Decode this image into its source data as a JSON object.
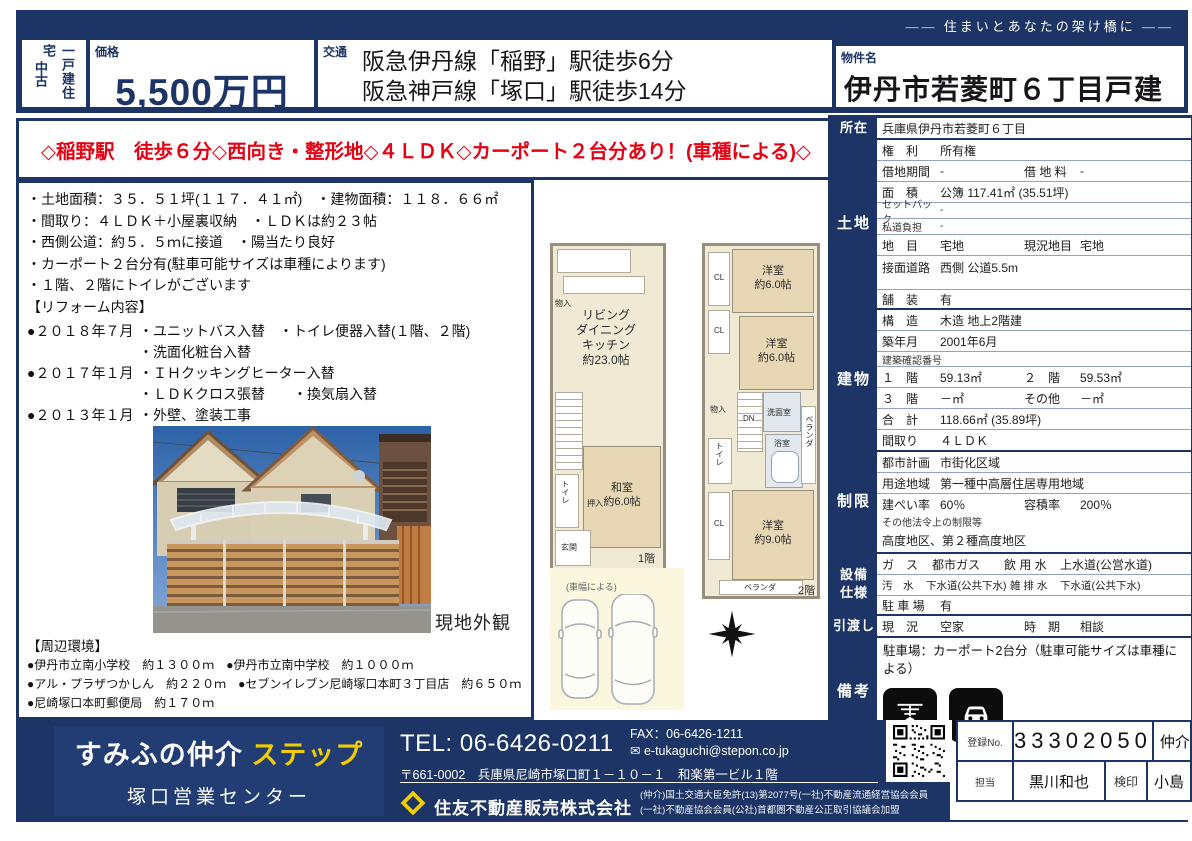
{
  "colors": {
    "navy": "#1c3566",
    "red": "#e60012",
    "yellow": "#f3cd00"
  },
  "header": {
    "tagline": "―― 住まいとあなたの架け橋に ――",
    "category_main": "一戸建住宅",
    "category_sub": "中古",
    "price_label": "価格",
    "price": "5,500万円",
    "traffic_label": "交通",
    "traffic_line1": "阪急伊丹線「稲野」駅徒歩6分",
    "traffic_line2": "阪急神戸線「塚口」駅徒歩14分",
    "name_label": "物件名",
    "name": "伊丹市若菱町６丁目戸建"
  },
  "catchcopy": "◇稲野駅　徒歩６分◇西向き・整形地◇４ＬＤＫ◇カーポート２台分あり！(車種による)◇",
  "notes": {
    "b1": "・土地面積：３５．５１坪(１１７．４１㎡)　・建物面積：１１８．６６㎡",
    "b2": "・間取り：４ＬＤＫ＋小屋裏収納　・ＬＤＫは約２３帖",
    "b3": "・西側公道：約５．５ｍに接道　・陽当たり良好",
    "b4": "・カーポート２台分有(駐車可能サイズは車種によります)",
    "b5": "・１階、２階にトイレがございます",
    "reform_title": "【リフォーム内容】",
    "r1_date": "●２０１８年７月",
    "r1_item": "・ユニットバス入替　・トイレ便器入替(１階、２階)",
    "r2_date": "",
    "r2_item": "・洗面化粧台入替",
    "r3_date": "●２０１７年１月",
    "r3_item": "・ＩＨクッキングヒーター入替",
    "r4_date": "",
    "r4_item": "・ＬＤＫクロス張替　　・換気扇入替",
    "r5_date": "●２０１３年１月",
    "r5_item": "・外壁、塗装工事",
    "photo_caption": "現地外観",
    "env_title": "【周辺環境】",
    "e1": "●伊丹市立南小学校　約１３００ｍ　●伊丹市立南中学校　約１０００ｍ",
    "e2": "●アル・プラザつかしん　約２２０ｍ　●セブンイレブン尼崎塚口本町３丁目店　約６５０ｍ",
    "e3": "●尼崎塚口本町郵便局　約１７０ｍ"
  },
  "floorplan": {
    "f1_ldk": "リビング\nダイニング\nキッチン\n約23.0帖",
    "f1_washitsu": "和室\n約6.0帖",
    "f1_toilet": "トイレ",
    "f1_monoire": "物入",
    "f1_oshiire": "押入",
    "f1_genkan": "玄関",
    "f1_floor": "1階",
    "f2_room1": "洋室\n約6.0帖",
    "f2_room2": "洋室\n約6.0帖",
    "f2_room3": "洋室\n約9.0帖",
    "f2_cl": "CL",
    "f2_cl2": "CL",
    "f2_cl3": "CL",
    "f2_dn": "DN",
    "f2_monoire": "物入",
    "f2_toilet": "トイレ",
    "f2_senmen": "洗面室",
    "f2_bath": "浴室",
    "f2_veranda1": "ベランダ",
    "f2_veranda2": "ベランダ",
    "f2_floor": "2階",
    "car_note": "(車幅による)"
  },
  "prop": {
    "shozai_label": "所在",
    "shozai": "兵庫県伊丹市若菱町６丁目",
    "tochi_label": "土地",
    "kenri_k": "権　利",
    "kenri_v": "所有権",
    "shakuchi_k": "借地期間",
    "shakuchi_v": "-",
    "shakuchiryo_k": "借 地 料",
    "shakuchiryo_v": "-",
    "menseki_k": "面　積",
    "menseki_v": "公簿 117.41㎡ (35.51坪)",
    "setback_k": "セットバック",
    "setback_v": "-",
    "shido_k": "私道負担",
    "shido_v": "-",
    "chimoku_k": "地　目",
    "chimoku_v": "宅地",
    "genchimoku_k": "現況地目",
    "genchimoku_v": "宅地",
    "setsumen_k": "接面道路",
    "setsumen_v": "西側 公道5.5m",
    "hoso_k": "舗　装",
    "hoso_v": "有",
    "tatemono_label": "建物",
    "kozo_k": "構　造",
    "kozo_v": "木造 地上2階建",
    "chikunen_k": "築年月",
    "chikunen_v": "2001年6月",
    "kakunin_k": "建築確認番号",
    "f1_k": "１　階",
    "f1_v": "59.13㎡",
    "f2_k": "２　階",
    "f2_v": "59.53㎡",
    "f3_k": "３　階",
    "f3_v": "－㎡",
    "sonota_k": "その他",
    "sonota_v": "－㎡",
    "gokei_k": "合　計",
    "gokei_v": "118.66㎡ (35.89坪)",
    "madori_k": "間取り",
    "madori_v": "４ＬＤＫ",
    "seigen_label": "制限",
    "toshikeikaku_k": "都市計画",
    "toshikeikaku_v": "市街化区域",
    "yoto_k": "用途地域",
    "yoto_v": "第一種中高層住居専用地域",
    "kenpei_k": "建ぺい率",
    "kenpei_v": "60％",
    "yoseki_k": "容積率",
    "yoseki_v": "200％",
    "sonohoka_k": "その他法令上の制限等",
    "sonohoka_v": "高度地区、第２種高度地区",
    "setsubi_label1": "設備",
    "setsubi_label2": "仕様",
    "gas_k": "ガ　ス",
    "gas_v": "都市ガス",
    "inyo_k": "飲 用 水",
    "inyo_v": "上水道(公営水道)",
    "osui_k": "汚　水",
    "osui_v": "下水道(公共下水)",
    "zatsu_k": "雑 排 水",
    "zatsu_v": "下水道(公共下水)",
    "chusha_k": "駐 車 場",
    "chusha_v": "有",
    "hikiwatashi_label": "引渡し",
    "genkyo_k": "現　況",
    "genkyo_v": "空家",
    "jiki_k": "時　期",
    "jiki_v": "相談",
    "biko_label": "備考",
    "biko_text": "駐車場：カーポート2台分（駐車可能サイズは車種による）",
    "amenity1": "浴室乾燥機付",
    "amenity2": "駐車場有"
  },
  "footer": {
    "brand1": "すみふの仲介",
    "brand2": "ステップ",
    "office": "塚口営業センター",
    "tel": "TEL: 06-6426-0211",
    "fax": "FAX：06-6426-1211",
    "email": "e-tukaguchi@stepon.co.jp",
    "address": "〒661-0002　兵庫県尼崎市塚口町１－１０－１　和楽第一ビル１階",
    "company": "住友不動産販売株式会社",
    "license1": "(仲介)国土交通大臣免許(13)第2077号(一社)不動産流通経営協会会員",
    "license2": "(一社)不動産協会会員(公社)首都圏不動産公正取引協議会加盟",
    "reg_label": "登録No.",
    "reg_no": "33302050",
    "reg_type": "仲介",
    "staff_label": "担当",
    "staff_name": "黒川和也",
    "seal_label": "検印",
    "seal_name": "小島"
  }
}
